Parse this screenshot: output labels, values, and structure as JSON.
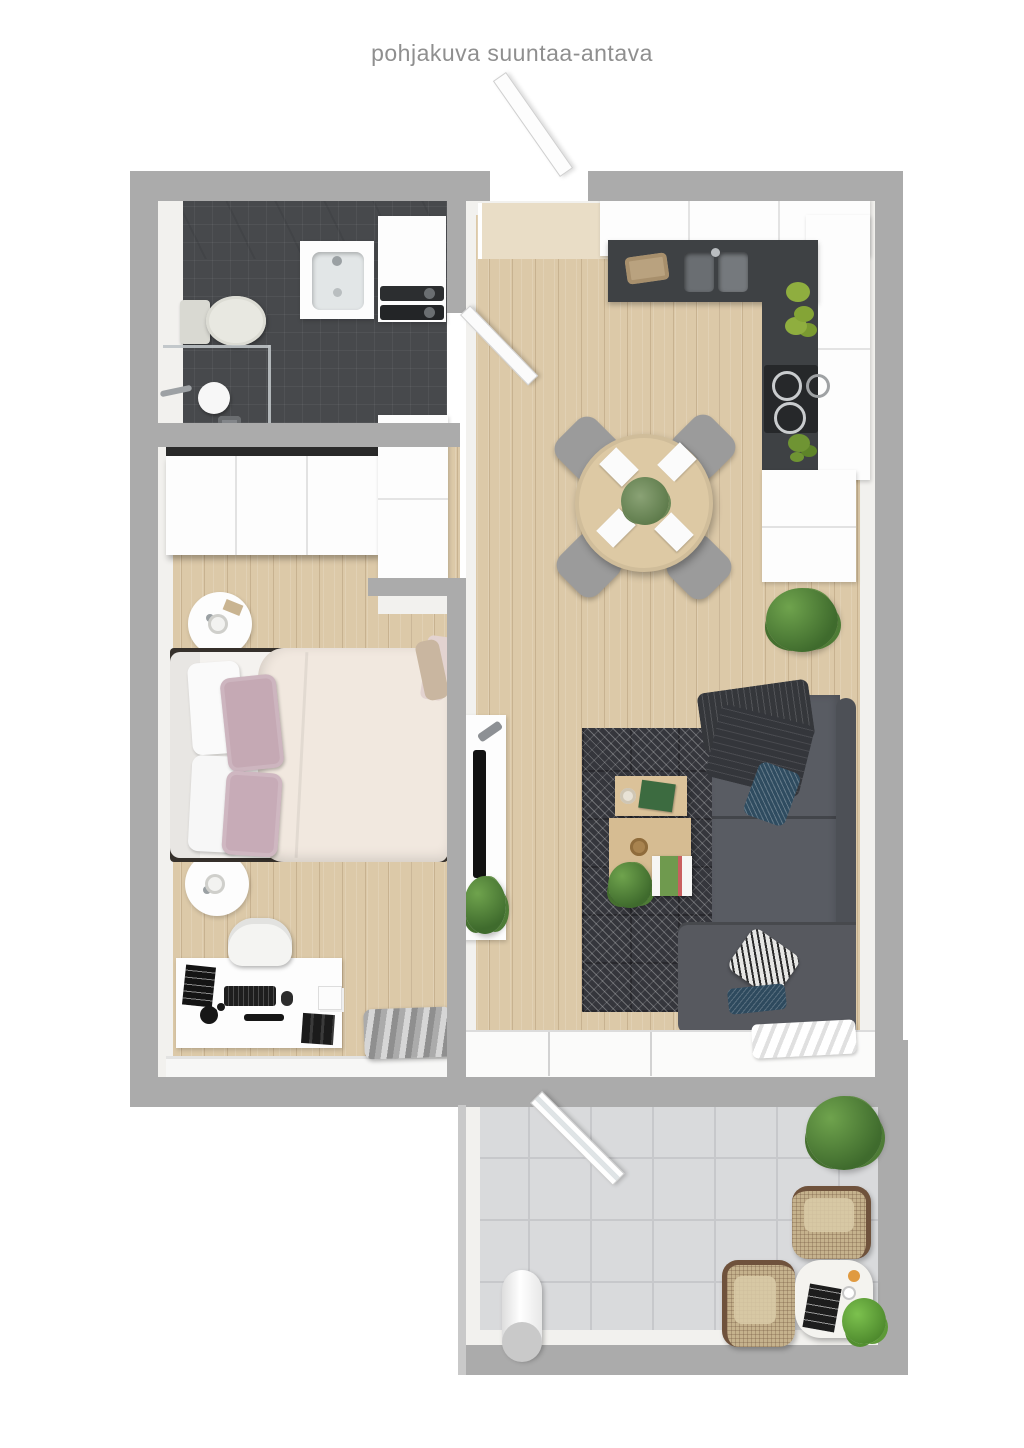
{
  "title": "pohjakuva suuntaa-antava",
  "colors": {
    "title_color": "#8f8f8f",
    "wall": "#ababab",
    "wall_face": "#f2f1ee",
    "floor_wood": "#dcc9a8",
    "bath_tile": "#47494c",
    "counter_dark": "#3e4144",
    "rug": "#35363c",
    "sofa": "#595c63",
    "sofa_back": "#4d5056",
    "blanket": "#35373b",
    "pillow_blue": "#2f4c60",
    "pillow_pink": "#c7abb7",
    "duvet": "#f1e8df",
    "table_wood": "#ddc9a4",
    "chair_gray": "#9b9b9b",
    "balcony_tile": "#d9dadc",
    "balcony_grout": "#c7c8cb",
    "plant_green": "#55823c",
    "wicker": "#6f523c",
    "wicker_seat": "#c5b28d"
  },
  "rooms": {
    "bathroom": {
      "name": "bathroom",
      "furniture": [
        "toilet",
        "sink-vanity",
        "washer-dryer-stack",
        "shower",
        "floor-drain",
        "glass-partition"
      ]
    },
    "bedroom": {
      "name": "bedroom",
      "furniture": [
        "wardrobe",
        "hall-closet",
        "double-bed",
        "pillows",
        "nightstand-top",
        "nightstand-bottom",
        "table-lamps",
        "desk",
        "desk-chair",
        "keyboard",
        "monitor",
        "desk-lamp",
        "books",
        "window-bench"
      ]
    },
    "living_kitchen": {
      "name": "living-room-and-kitchen",
      "furniture": [
        "upper-cabinets",
        "counter-top",
        "double-sink",
        "bread-basket",
        "apples",
        "cooktop",
        "cabinet-block",
        "floor-plant",
        "round-dining-table",
        "four-dining-chairs",
        "place-settings",
        "centerpiece",
        "rug",
        "nesting-coffee-tables",
        "corner-sofa",
        "throw-blanket",
        "cushions",
        "tv-console",
        "tv",
        "remote",
        "tv-plant",
        "sliding-window",
        "curtain"
      ]
    },
    "balcony": {
      "name": "balcony",
      "furniture": [
        "open-glass-door",
        "bush-plant",
        "wicker-chair-upper",
        "wicker-chair-lower",
        "round-side-table",
        "magazine",
        "cup",
        "orange",
        "table-plant",
        "storage-roll"
      ]
    }
  }
}
